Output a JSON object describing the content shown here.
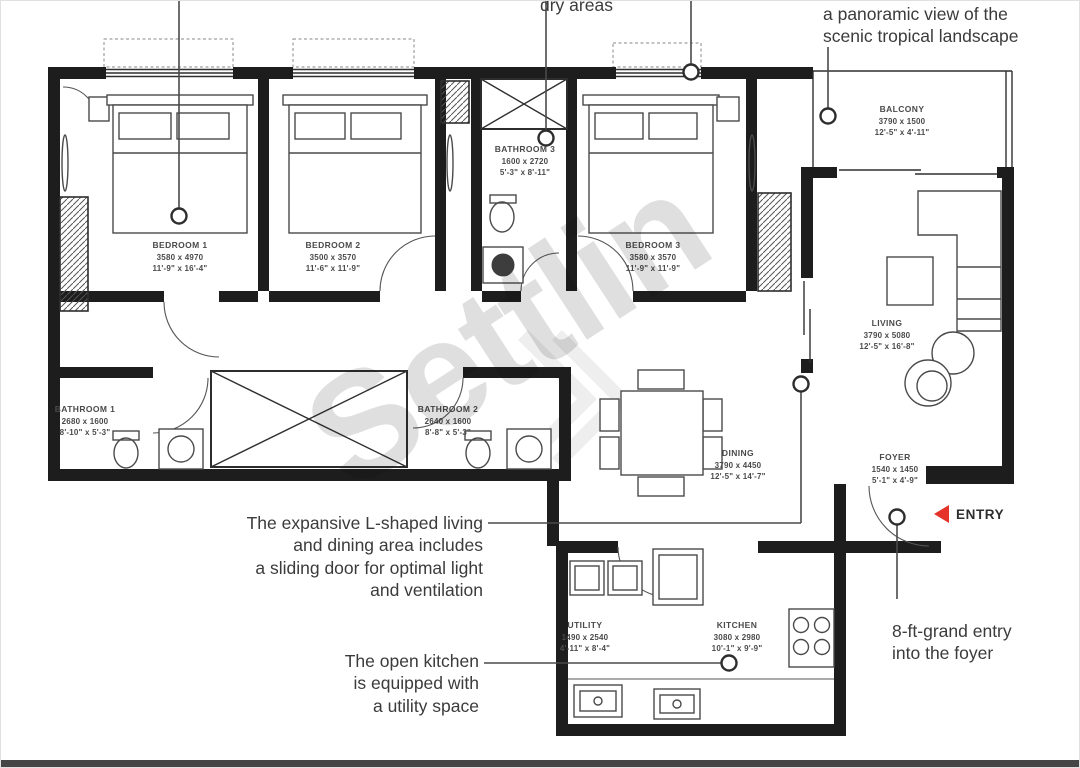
{
  "watermark": "Settlin",
  "annotations": {
    "dry_areas": "dry areas",
    "panoramic": "a panoramic view of the\nscenic tropical landscape",
    "living": "The expansive L-shaped living\nand dining area includes\na sliding door for optimal light\nand ventilation",
    "kitchen": "The open kitchen\nis equipped with\na utility space",
    "entry": "8-ft-grand entry\ninto the foyer",
    "entry_label": "ENTRY"
  },
  "rooms": {
    "bedroom1": {
      "name": "BEDROOM 1",
      "mm": "3580 x 4970",
      "ft": "11'-9\" x 16'-4\""
    },
    "bedroom2": {
      "name": "BEDROOM 2",
      "mm": "3500 x 3570",
      "ft": "11'-6\" x 11'-9\""
    },
    "bedroom3": {
      "name": "BEDROOM 3",
      "mm": "3580 x 3570",
      "ft": "11'-9\" x 11'-9\""
    },
    "bathroom1": {
      "name": "BATHROOM 1",
      "mm": "2680 x 1600",
      "ft": "8'-10\" x 5'-3\""
    },
    "bathroom2": {
      "name": "BATHROOM 2",
      "mm": "2640 x 1600",
      "ft": "8'-8\" x 5'-3\""
    },
    "bathroom3": {
      "name": "BATHROOM 3",
      "mm": "1600 x 2720",
      "ft": "5'-3\" x 8'-11\""
    },
    "balcony": {
      "name": "BALCONY",
      "mm": "3790 x 1500",
      "ft": "12'-5\" x 4'-11\""
    },
    "living": {
      "name": "LIVING",
      "mm": "3790 x 5080",
      "ft": "12'-5\" x 16'-8\""
    },
    "dining": {
      "name": "DINING",
      "mm": "3790 x 4450",
      "ft": "12'-5\" x 14'-7\""
    },
    "foyer": {
      "name": "FOYER",
      "mm": "1540 x 1450",
      "ft": "5'-1\" x 4'-9\""
    },
    "utility": {
      "name": "UTILITY",
      "mm": "1490 x 2540",
      "ft": "4'-11\" x 8'-4\""
    },
    "kitchen": {
      "name": "KITCHEN",
      "mm": "3080 x 2980",
      "ft": "10'-1\" x 9'-9\""
    }
  }
}
